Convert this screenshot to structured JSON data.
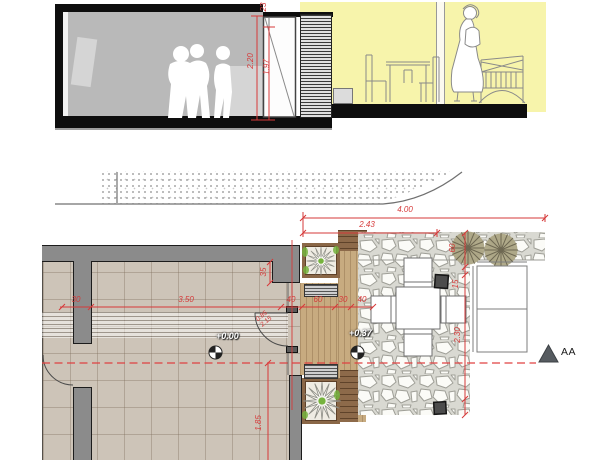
{
  "drawing": {
    "type": "architectural plan and section",
    "section_view": {
      "dim_transom": "23",
      "dim_opening_height": "2.20",
      "dim_door_height": "1.97"
    },
    "plan_view": {
      "dim_total_width": "4.00",
      "dim_terrace_width": "2.43",
      "h_chain": [
        "30",
        "3.50",
        "40",
        "60",
        "30",
        "40"
      ],
      "dim_wall_return": "35",
      "v_chain": [
        "60",
        "15",
        "2.30"
      ],
      "dim_room_depth": "1.85",
      "door_tag_line1": "0.85",
      "door_tag_line2": "2.15",
      "level_interior": "+0.00",
      "level_terrace": "+0.37"
    },
    "section_marker_label": "AA",
    "colors": {
      "dimension_red": "#d63939",
      "terrace_yellow": "#f7f4ab",
      "wall_gray": "#8b8b8b",
      "floor_tile": "#cdc4b8",
      "deck_wood": "#c7ab80",
      "plant_green": "#76b33e"
    }
  }
}
